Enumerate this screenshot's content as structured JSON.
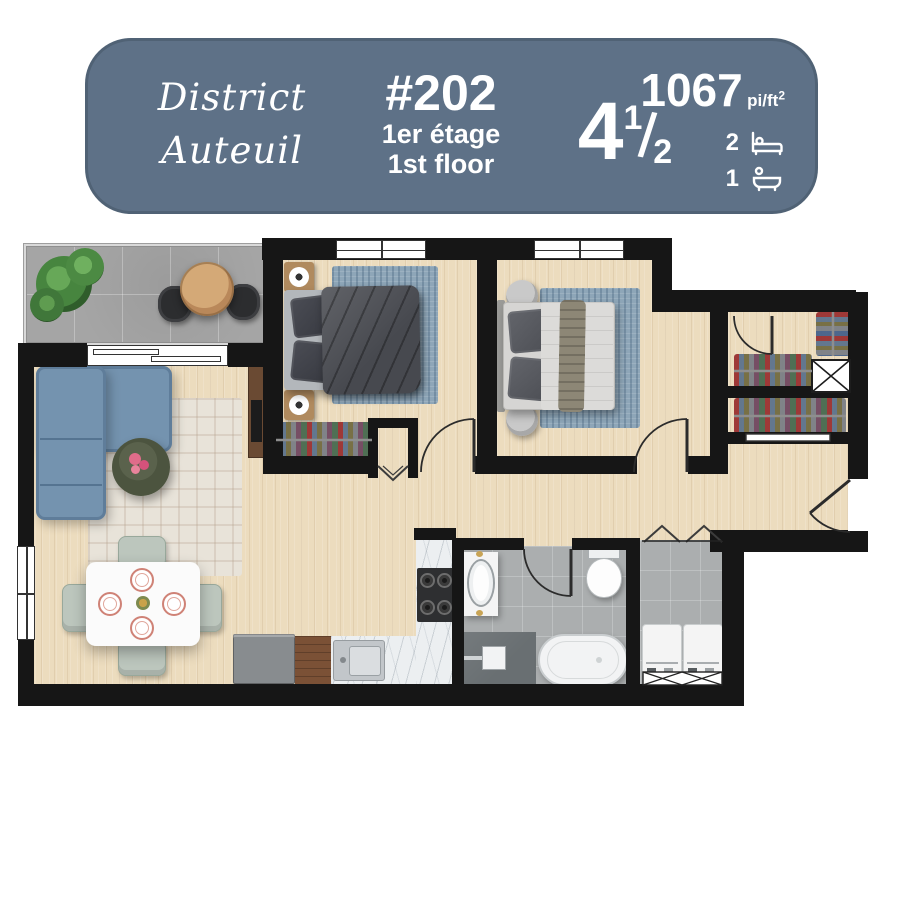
{
  "badge": {
    "brand": {
      "line1": "District",
      "line2": "Auteuil"
    },
    "unit": {
      "number": "#202",
      "floor_fr": "1er étage",
      "floor_en": "1st floor"
    },
    "rooms": {
      "whole": "4",
      "fraction_numerator": "1",
      "fraction_separator": "/",
      "fraction_denominator": "2"
    },
    "area": {
      "value": "1067",
      "unit": "pi/ft",
      "exponent": "2"
    },
    "features": {
      "bedrooms": "2",
      "bathrooms": "1"
    },
    "icons": {
      "bedrooms": "bed-icon",
      "bathrooms": "bathtub-icon"
    },
    "colors": {
      "background": "#5e7187",
      "text": "#ffffff"
    }
  },
  "floorplan": {
    "colors": {
      "walls": "#161616",
      "wood_floor": "#ecdcbe",
      "balcony_tile": "#a5a5a5",
      "bathroom_tile": "#abaeaf",
      "sofa": "#7493af",
      "bed1_duvet": "#46484e",
      "bed2_bedding": "#dcdbd9",
      "area_rug_blue": "#8ea6b8",
      "living_rug": "#e8e3d9",
      "coffee_table": "#4c543f",
      "counter_marble": "#eceff1",
      "cabinet_wood": "#7b5136",
      "shower_pan": "#696f72",
      "flower_accent": "#e06c8a"
    }
  }
}
